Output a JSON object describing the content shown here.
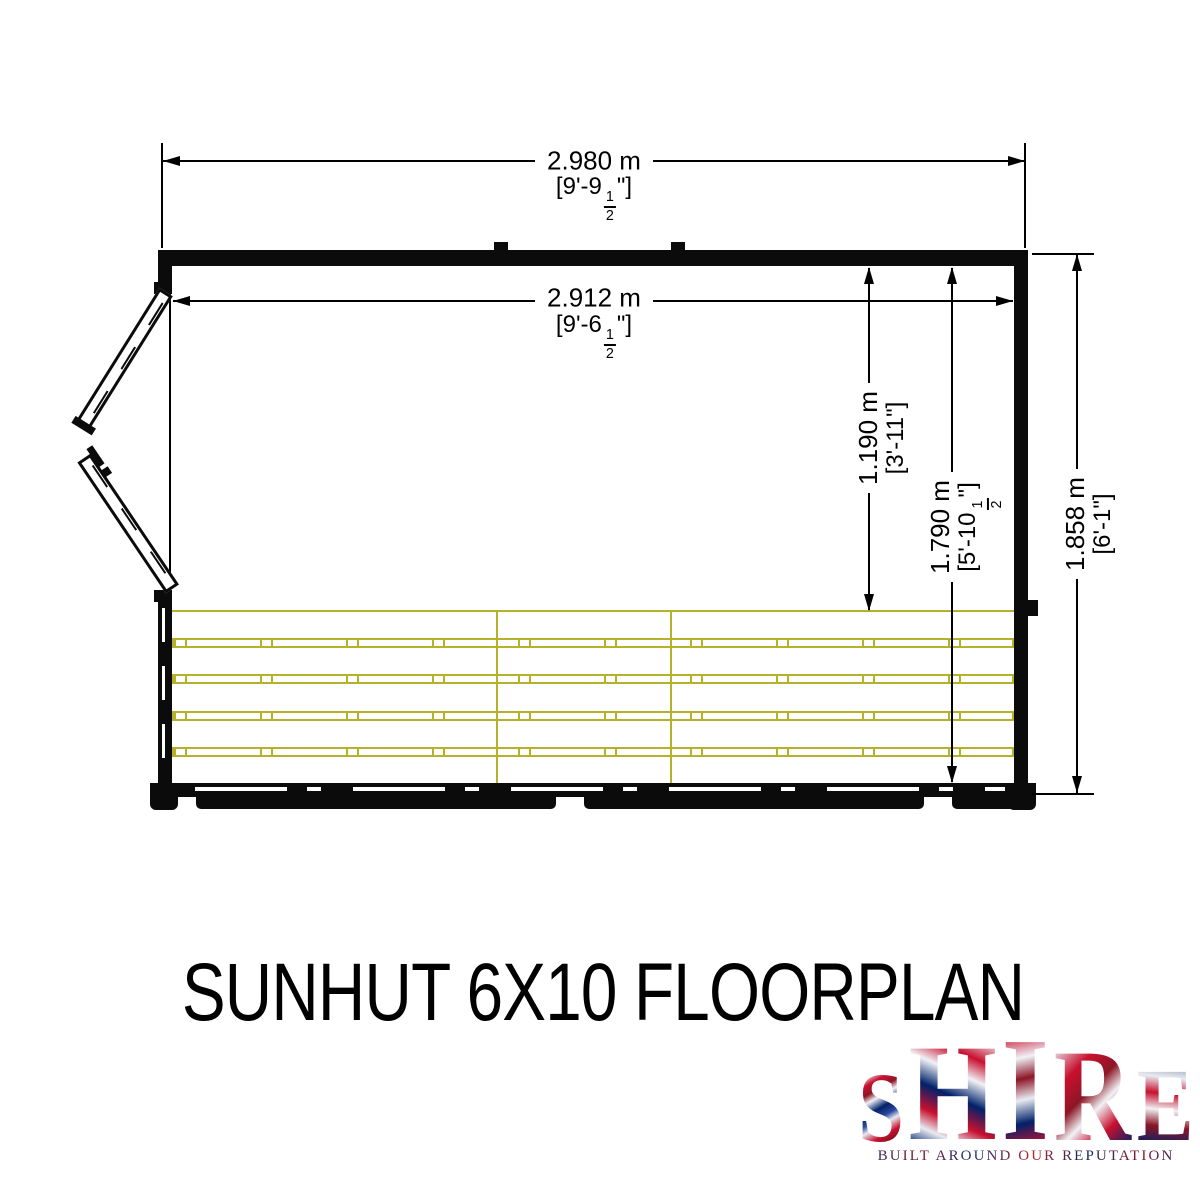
{
  "title": "SUNHUT 6X10 FLOORPLAN",
  "dims": {
    "overall_width": {
      "metric": "2.980 m",
      "imp_pre": "[9'-9",
      "fnum": "1",
      "fden": "2",
      "imp_suf": "\"]"
    },
    "internal_width": {
      "metric": "2.912 m",
      "imp_pre": "[9'-6",
      "fnum": "1",
      "fden": "2",
      "imp_suf": "\"]"
    },
    "bench_depth": {
      "metric": "1.190 m",
      "imperial": "[3'-11\"]"
    },
    "internal_depth": {
      "metric": "1.790 m",
      "imp_pre": "[5'-10",
      "fnum": "1",
      "fden": "2",
      "imp_suf": "\"]"
    },
    "overall_depth": {
      "metric": "1.858 m",
      "imperial": "[6'-1\"]"
    }
  },
  "logo": {
    "name": "SHIRE",
    "letters": [
      "S",
      "H",
      "I",
      "R",
      "E"
    ],
    "tagline": "BUILT AROUND OUR REPUTATION"
  },
  "colors": {
    "line_black": "#0b0b0b",
    "staging_yellow": "#b5b128",
    "flag_navy": "#012169",
    "flag_red": "#c8102e"
  }
}
